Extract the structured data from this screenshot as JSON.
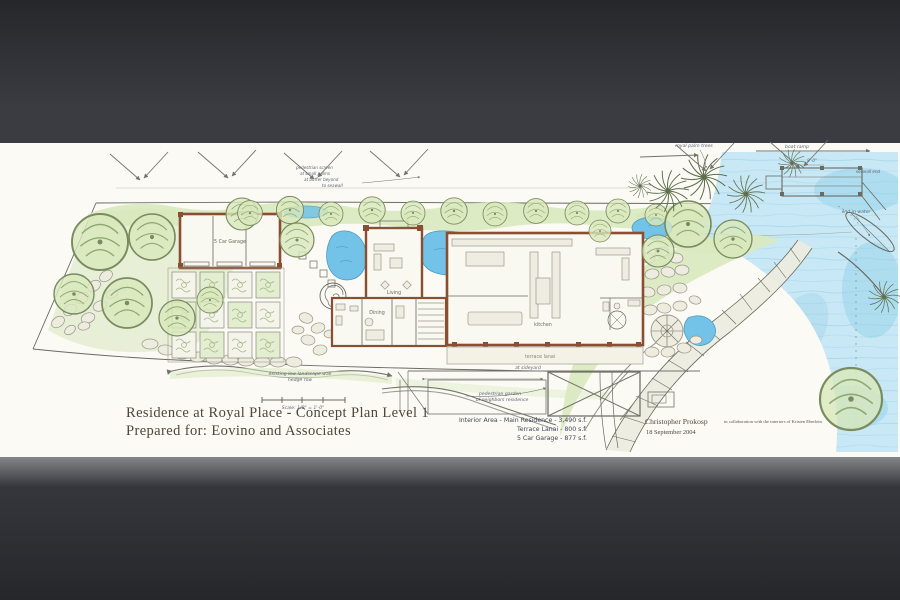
{
  "palette": {
    "backdrop": "#3a3c42",
    "paper": "#fbfaf5",
    "ink": "#6a6a60",
    "pencil": "#73736c",
    "wall": "#8a4f32",
    "pool": "#72c3e7",
    "pool_deep": "#3f9fce",
    "lake": "#c9e8f5",
    "lake_wave": "#93cde8",
    "foliage": "#d7e8bc",
    "foliage_stroke": "#85a068",
    "lawn": "#d9e9bf",
    "stone": "#edecdf",
    "stone_edge": "#97978a"
  },
  "titleblock": {
    "line1": "Residence at Royal Place -   Concept  Plan Level 1",
    "line2": "Prepared for: Eovino and Associates"
  },
  "areas": {
    "line1": "Interior Area - Main Residence - 3,490 s.f.",
    "line2": "Terrace Lanai - 800 s.f.",
    "line3": "5 Car Garage - 877 s.f."
  },
  "credits": {
    "designer": "Christopher Prokosp",
    "collaboration": "in collaboration with the interiors of Kristen Eberlein",
    "date": "18 September 2004"
  },
  "labels": {
    "garage": "5 Car Garage",
    "living": "Living",
    "dining": "Dining",
    "kitchen": "kitchen",
    "lanai": "terrace lanai",
    "scale": "Scale: 1/8\" = 1'-0\""
  },
  "annotations": {
    "screen1": "pedestrian screen",
    "screen2": "at small palms",
    "screen3": "at buffer beyond",
    "screen4": "to seawall",
    "hedge1": "existing low landscape wall",
    "hedge2": "hedge row",
    "neighbor1": "pedestrian garden",
    "neighbor2": "of neighbors residence",
    "sideyard": "at sideyard",
    "palms": "royal palm trees",
    "ramp": "boat ramp",
    "dockdim": "8'-0\"",
    "seawall": "seawall end",
    "water": "end in water"
  }
}
